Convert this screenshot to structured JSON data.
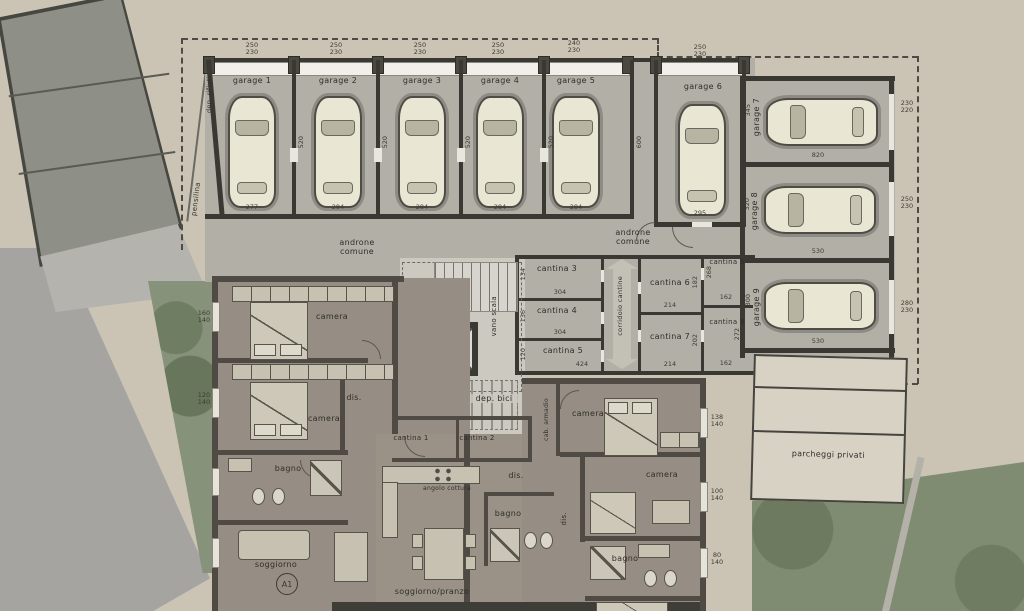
{
  "plan": {
    "site": {
      "parcheggi_label": "parcheggi privati",
      "pensilina_label": "pensilina",
      "dep_rifiuti_label": "dep. rifiuti"
    },
    "common": {
      "androne_label": "androne comune",
      "corridoio_label": "corridoio cantine",
      "vano_scala_label": "vano scala",
      "dep_bici_label": "dep. bici"
    },
    "garages": [
      {
        "label": "garage 1",
        "door_dim": "250 230",
        "width_dim": "277",
        "depth_dim": "520"
      },
      {
        "label": "garage 2",
        "door_dim": "250 230",
        "width_dim": "284",
        "depth_dim": "520"
      },
      {
        "label": "garage 3",
        "door_dim": "250 230",
        "width_dim": "284",
        "depth_dim": "520"
      },
      {
        "label": "garage 4",
        "door_dim": "250 230",
        "width_dim": "284",
        "depth_dim": "520"
      },
      {
        "label": "garage 5",
        "door_dim": "240 230",
        "width_dim": "284",
        "depth_dim": "600"
      },
      {
        "label": "garage 6",
        "door_dim": "250 230",
        "width_dim": "295",
        "depth_dim": ""
      },
      {
        "label": "garage 7",
        "door_dim": "230 220",
        "length_dim": "820",
        "depth_dim": "345"
      },
      {
        "label": "garage 8",
        "door_dim": "250 230",
        "length_dim": "530",
        "depth_dim": "320"
      },
      {
        "label": "garage 9",
        "door_dim": "280 230",
        "length_dim": "530",
        "depth_dim": "300"
      }
    ],
    "cantine": [
      {
        "label": "cantina 1",
        "w": "",
        "h": ""
      },
      {
        "label": "cantina 2",
        "w": "",
        "h": ""
      },
      {
        "label": "cantina 3",
        "w": "304",
        "h": "134"
      },
      {
        "label": "cantina 4",
        "w": "304",
        "h": "136"
      },
      {
        "label": "cantina 5",
        "w": "424",
        "h": "120"
      },
      {
        "label": "cantina 6",
        "w": "214",
        "h": "182"
      },
      {
        "label": "cantina 7",
        "w": "214",
        "h": "202"
      },
      {
        "label": "cantina 8",
        "w": "162",
        "h": "268"
      },
      {
        "label": "cantina 9",
        "w": "162",
        "h": "272"
      }
    ],
    "apartment": {
      "camera_label": "camera",
      "bagno_label": "bagno",
      "dis_label": "dis.",
      "cab_armadio_label": "cab. armadio",
      "soggiorno_label": "soggiorno",
      "soggiorno_pranzo_label": "soggiorno/pranzo",
      "angolo_cottura_label": "angolo cottura",
      "unit_badge": "A1",
      "window_dims_left": [
        "160 140",
        "120 140"
      ],
      "window_dims_right": [
        "138 140",
        "100 140",
        "80 140"
      ]
    },
    "colors": {
      "paper": "#cbc4b5",
      "concrete": "#b2afa7",
      "wall": "#3a3833",
      "apartment_floor": "#968e84",
      "car_body": "#e9e6d4",
      "green": "#87927a",
      "road": "#a5a4a1",
      "parking": "#d8d2c4"
    }
  }
}
